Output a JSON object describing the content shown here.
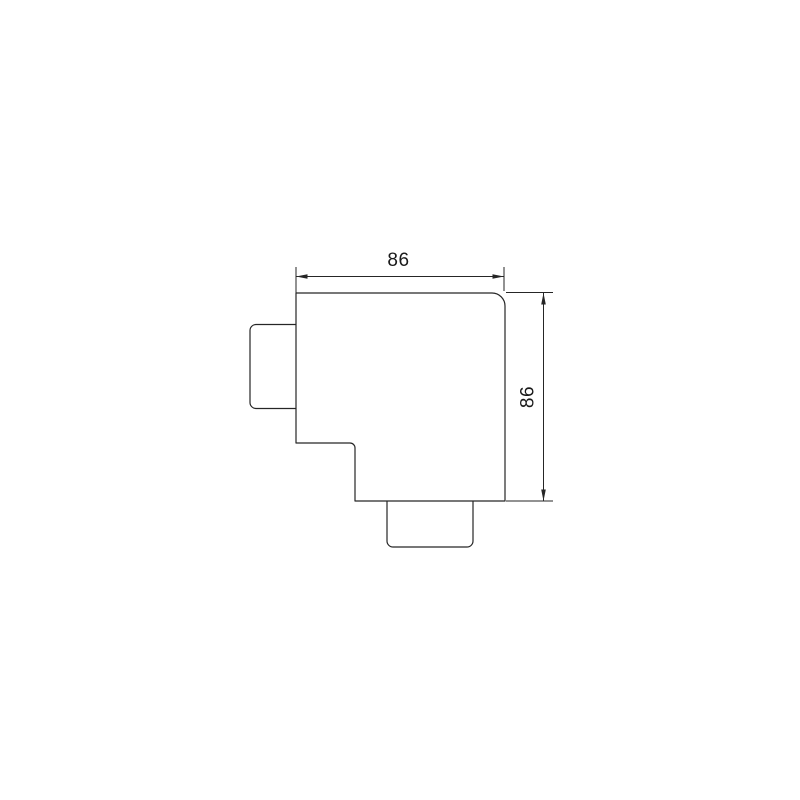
{
  "drawing": {
    "dimensions": {
      "width": {
        "value": 86,
        "label": "86"
      },
      "height": {
        "value": 86,
        "label": "86"
      }
    },
    "style": {
      "line_color": "#262626",
      "background_color": "#ffffff"
    }
  }
}
